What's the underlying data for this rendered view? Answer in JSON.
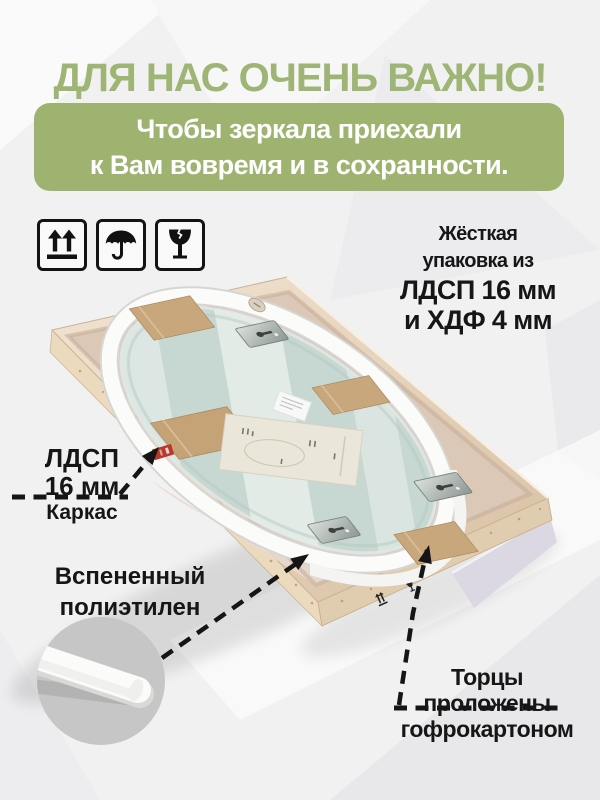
{
  "header": {
    "title": "ДЛЯ НАС ОЧЕНЬ ВАЖНО!",
    "banner_line1": "Чтобы зеркала приехали",
    "banner_line2": "к Вам вовремя и в сохранности."
  },
  "colors": {
    "title_green": "#9fb576",
    "accent_green": "#9db36f",
    "text_black": "#161616",
    "banner_text": "#ffffff"
  },
  "handling_icons": [
    {
      "name": "this-way-up-icon"
    },
    {
      "name": "keep-dry-icon"
    },
    {
      "name": "fragile-icon"
    }
  ],
  "specs": {
    "line1": "Жёсткая",
    "line2": "упаковка из",
    "line3": "ЛДСП 16 мм",
    "line4": "и ХДФ 4 мм"
  },
  "callout_frame": {
    "line1": "ЛДСП",
    "line2": "16 мм",
    "line3": "Каркас"
  },
  "callout_foam": {
    "line1": "Вспененный",
    "line2": "полиэтилен"
  },
  "callout_edges": {
    "line1": "Торцы",
    "line2": "проложены",
    "line3": "гофрокартоном"
  }
}
